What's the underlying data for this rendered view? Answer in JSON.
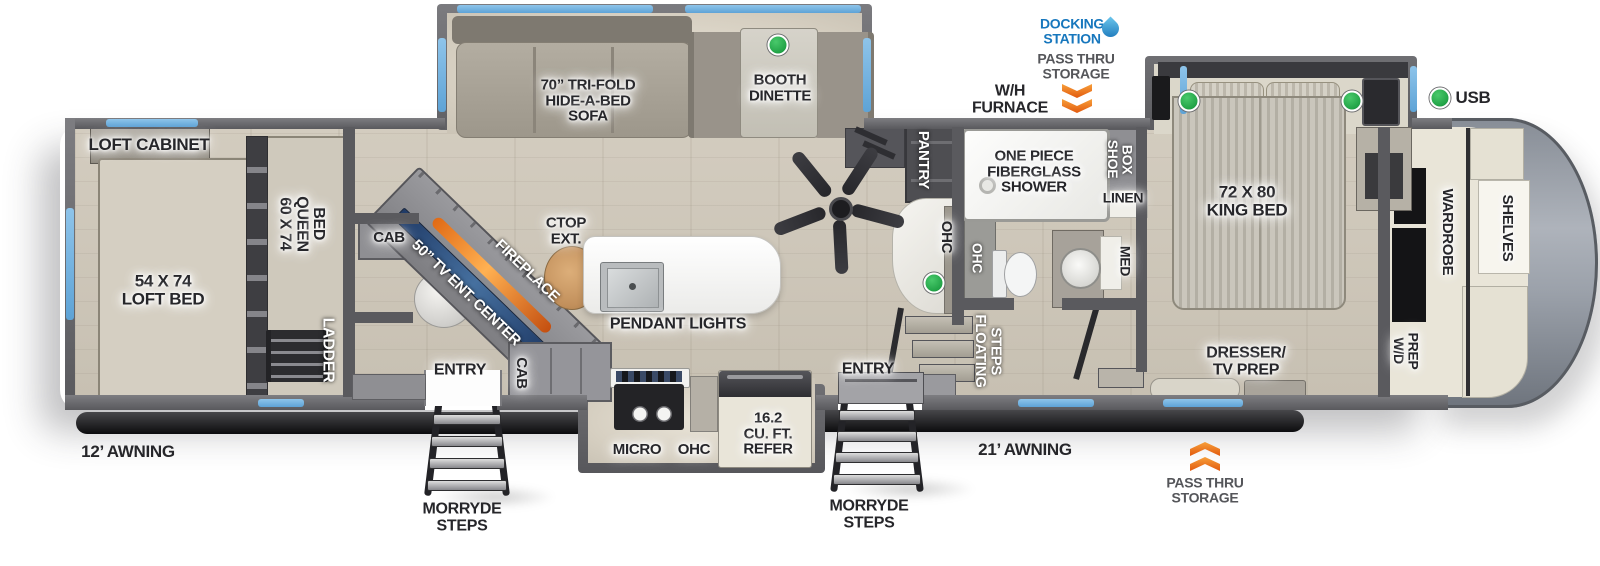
{
  "diagram": {
    "type": "rv-fifth-wheel-floorplan",
    "awning_rear": "12’ AWNING",
    "awning_main": "21’ AWNING"
  },
  "colors": {
    "wall": "#5a5a5e",
    "floor_wood": "#cdc6b9",
    "slide_floor": "#ddd6c9",
    "window_blue": "#6fb3e0",
    "accent_green": "#22a347",
    "accent_orange": "#ee7018",
    "docking_blue": "#1777bd",
    "muted_gray": "#55565a",
    "label_dark": "#26262a",
    "cream": "#e9e5d8",
    "black_bar": "#141416"
  },
  "labels": [
    {
      "name": "loft-cabinet",
      "text": "LOFT CABINET",
      "x": 149,
      "y": 145,
      "s": 17,
      "mode": "h",
      "glow": "glow"
    },
    {
      "name": "loft-bed",
      "text": "54 X 74\nLOFT BED",
      "x": 163,
      "y": 290,
      "s": 17,
      "mode": "h",
      "glow": "glow"
    },
    {
      "name": "queen-bed",
      "text": "60 X 74\nQUEEN\nBED",
      "x": 301,
      "y": 224,
      "s": 16,
      "mode": "v",
      "glow": "glow"
    },
    {
      "name": "ladder",
      "text": "LADDER",
      "x": 327,
      "y": 350,
      "s": 16,
      "mode": "v",
      "glow": "dark"
    },
    {
      "name": "awning-12",
      "text": "12’ AWNING",
      "x": 128,
      "y": 452,
      "s": 17,
      "mode": "h",
      "glow": "none"
    },
    {
      "name": "cab-upper",
      "text": "CAB",
      "x": 389,
      "y": 238,
      "s": 15,
      "mode": "h",
      "glow": "glow"
    },
    {
      "name": "tv-ent-center",
      "text": "50” TV ENT. CENTER",
      "x": 466,
      "y": 293,
      "s": 15,
      "mode": "h",
      "rot": 44,
      "glow": "dark"
    },
    {
      "name": "fireplace",
      "text": "FIREPLACE",
      "x": 527,
      "y": 271,
      "s": 15,
      "mode": "h",
      "rot": 44,
      "glow": "dark"
    },
    {
      "name": "entry-left",
      "text": "ENTRY",
      "x": 460,
      "y": 371,
      "s": 16,
      "mode": "h",
      "glow": "glow"
    },
    {
      "name": "cab-lower",
      "text": "CAB",
      "x": 521,
      "y": 373,
      "s": 15,
      "mode": "v",
      "glow": "glow"
    },
    {
      "name": "morryde-steps-left",
      "text": "MORRYDE\nSTEPS",
      "x": 462,
      "y": 518,
      "s": 16,
      "mode": "h",
      "glow": "none"
    },
    {
      "name": "sofa",
      "text": "70” TRI-FOLD\nHIDE-A-BED\nSOFA",
      "x": 588,
      "y": 101,
      "s": 15,
      "mode": "h",
      "glow": "glow"
    },
    {
      "name": "booth-dinette",
      "text": "BOOTH\nDINETTE",
      "x": 780,
      "y": 88,
      "s": 15,
      "mode": "h",
      "glow": "glow"
    },
    {
      "name": "ctop-ext",
      "text": "CTOP\nEXT.",
      "x": 566,
      "y": 231,
      "s": 15,
      "mode": "h",
      "glow": "glow"
    },
    {
      "name": "pendant-lights",
      "text": "PENDANT LIGHTS",
      "x": 678,
      "y": 325,
      "s": 16,
      "mode": "h",
      "glow": "glow"
    },
    {
      "name": "micro",
      "text": "MICRO",
      "x": 637,
      "y": 450,
      "s": 15,
      "mode": "h",
      "glow": "glow"
    },
    {
      "name": "ohc-kitchen",
      "text": "OHC",
      "x": 694,
      "y": 450,
      "s": 15,
      "mode": "h",
      "glow": "glow"
    },
    {
      "name": "refer",
      "text": "16.2\nCU. FT.\nREFER",
      "x": 768,
      "y": 434,
      "s": 15,
      "mode": "h",
      "glow": "glow"
    },
    {
      "name": "entry-right",
      "text": "ENTRY",
      "x": 868,
      "y": 370,
      "s": 16,
      "mode": "h",
      "glow": "glow"
    },
    {
      "name": "morryde-steps-right",
      "text": "MORRYDE\nSTEPS",
      "x": 869,
      "y": 515,
      "s": 16,
      "mode": "h",
      "glow": "none"
    },
    {
      "name": "awning-21",
      "text": "21’ AWNING",
      "x": 1025,
      "y": 450,
      "s": 17,
      "mode": "h",
      "glow": "none"
    },
    {
      "name": "wh-furnace",
      "text": "W/H\nFURNACE",
      "x": 1010,
      "y": 100,
      "s": 16,
      "mode": "h",
      "glow": "none"
    },
    {
      "name": "docking-station",
      "text": "DOCKING\nSTATION",
      "x": 1072,
      "y": 31,
      "s": 14,
      "mode": "h",
      "color": "#1777bd",
      "glow": "none"
    },
    {
      "name": "pass-thru-storage-top",
      "text": "PASS THRU\nSTORAGE",
      "x": 1076,
      "y": 66,
      "s": 14,
      "mode": "h",
      "color": "#55565a",
      "glow": "none"
    },
    {
      "name": "pantry",
      "text": "PANTRY",
      "x": 923,
      "y": 160,
      "s": 15,
      "mode": "v",
      "glow": "dark"
    },
    {
      "name": "ohc-desk",
      "text": "OHC",
      "x": 946,
      "y": 237,
      "s": 15,
      "mode": "v",
      "glow": "glow"
    },
    {
      "name": "ohc-bath",
      "text": "OHC",
      "x": 977,
      "y": 258,
      "s": 14,
      "mode": "v",
      "glow": "dark"
    },
    {
      "name": "shower",
      "text": "ONE PIECE\nFIBERGLASS\nSHOWER",
      "x": 1034,
      "y": 172,
      "s": 15,
      "mode": "h",
      "glow": "glow"
    },
    {
      "name": "shoe-box",
      "text": "SHOE\nBOX",
      "x": 1120,
      "y": 159,
      "s": 14,
      "mode": "v",
      "glow": "dark"
    },
    {
      "name": "linen",
      "text": "LINEN",
      "x": 1123,
      "y": 198,
      "s": 14,
      "mode": "h",
      "glow": "glow"
    },
    {
      "name": "med",
      "text": "MED",
      "x": 1125,
      "y": 261,
      "s": 14,
      "mode": "v",
      "glow": "glow"
    },
    {
      "name": "floating-steps",
      "text": "FLOATING\nSTEPS",
      "x": 988,
      "y": 351,
      "s": 15,
      "mode": "v",
      "glow": "dark"
    },
    {
      "name": "king-bed",
      "text": "72 X 80\nKING BED",
      "x": 1247,
      "y": 201,
      "s": 17,
      "mode": "h",
      "glow": "glow"
    },
    {
      "name": "dresser-tv-prep",
      "text": "DRESSER/\nTV PREP",
      "x": 1246,
      "y": 362,
      "s": 16,
      "mode": "h",
      "glow": "glow"
    },
    {
      "name": "usb",
      "text": "USB",
      "x": 1473,
      "y": 98,
      "s": 17,
      "mode": "h",
      "glow": "none"
    },
    {
      "name": "pass-thru-storage-bottom",
      "text": "PASS THRU\nSTORAGE",
      "x": 1205,
      "y": 490,
      "s": 14,
      "mode": "h",
      "color": "#55565a",
      "glow": "none"
    },
    {
      "name": "wd-prep",
      "text": "W/D\nPREP",
      "x": 1406,
      "y": 351,
      "s": 14,
      "mode": "v",
      "glow": "glow"
    },
    {
      "name": "wardrobe",
      "text": "WARDROBE",
      "x": 1447,
      "y": 232,
      "s": 15,
      "mode": "v",
      "glow": "glow"
    },
    {
      "name": "shelves",
      "text": "SHELVES",
      "x": 1507,
      "y": 228,
      "s": 15,
      "mode": "v",
      "glow": "glow"
    }
  ],
  "indicators": [
    {
      "name": "light-booth-dinette",
      "x": 778,
      "y": 45
    },
    {
      "name": "light-desk",
      "x": 934,
      "y": 283
    },
    {
      "name": "light-bed-left",
      "x": 1189,
      "y": 101
    },
    {
      "name": "light-bed-right",
      "x": 1352,
      "y": 101
    },
    {
      "name": "usb-legend-dot",
      "x": 1440,
      "y": 98
    }
  ]
}
